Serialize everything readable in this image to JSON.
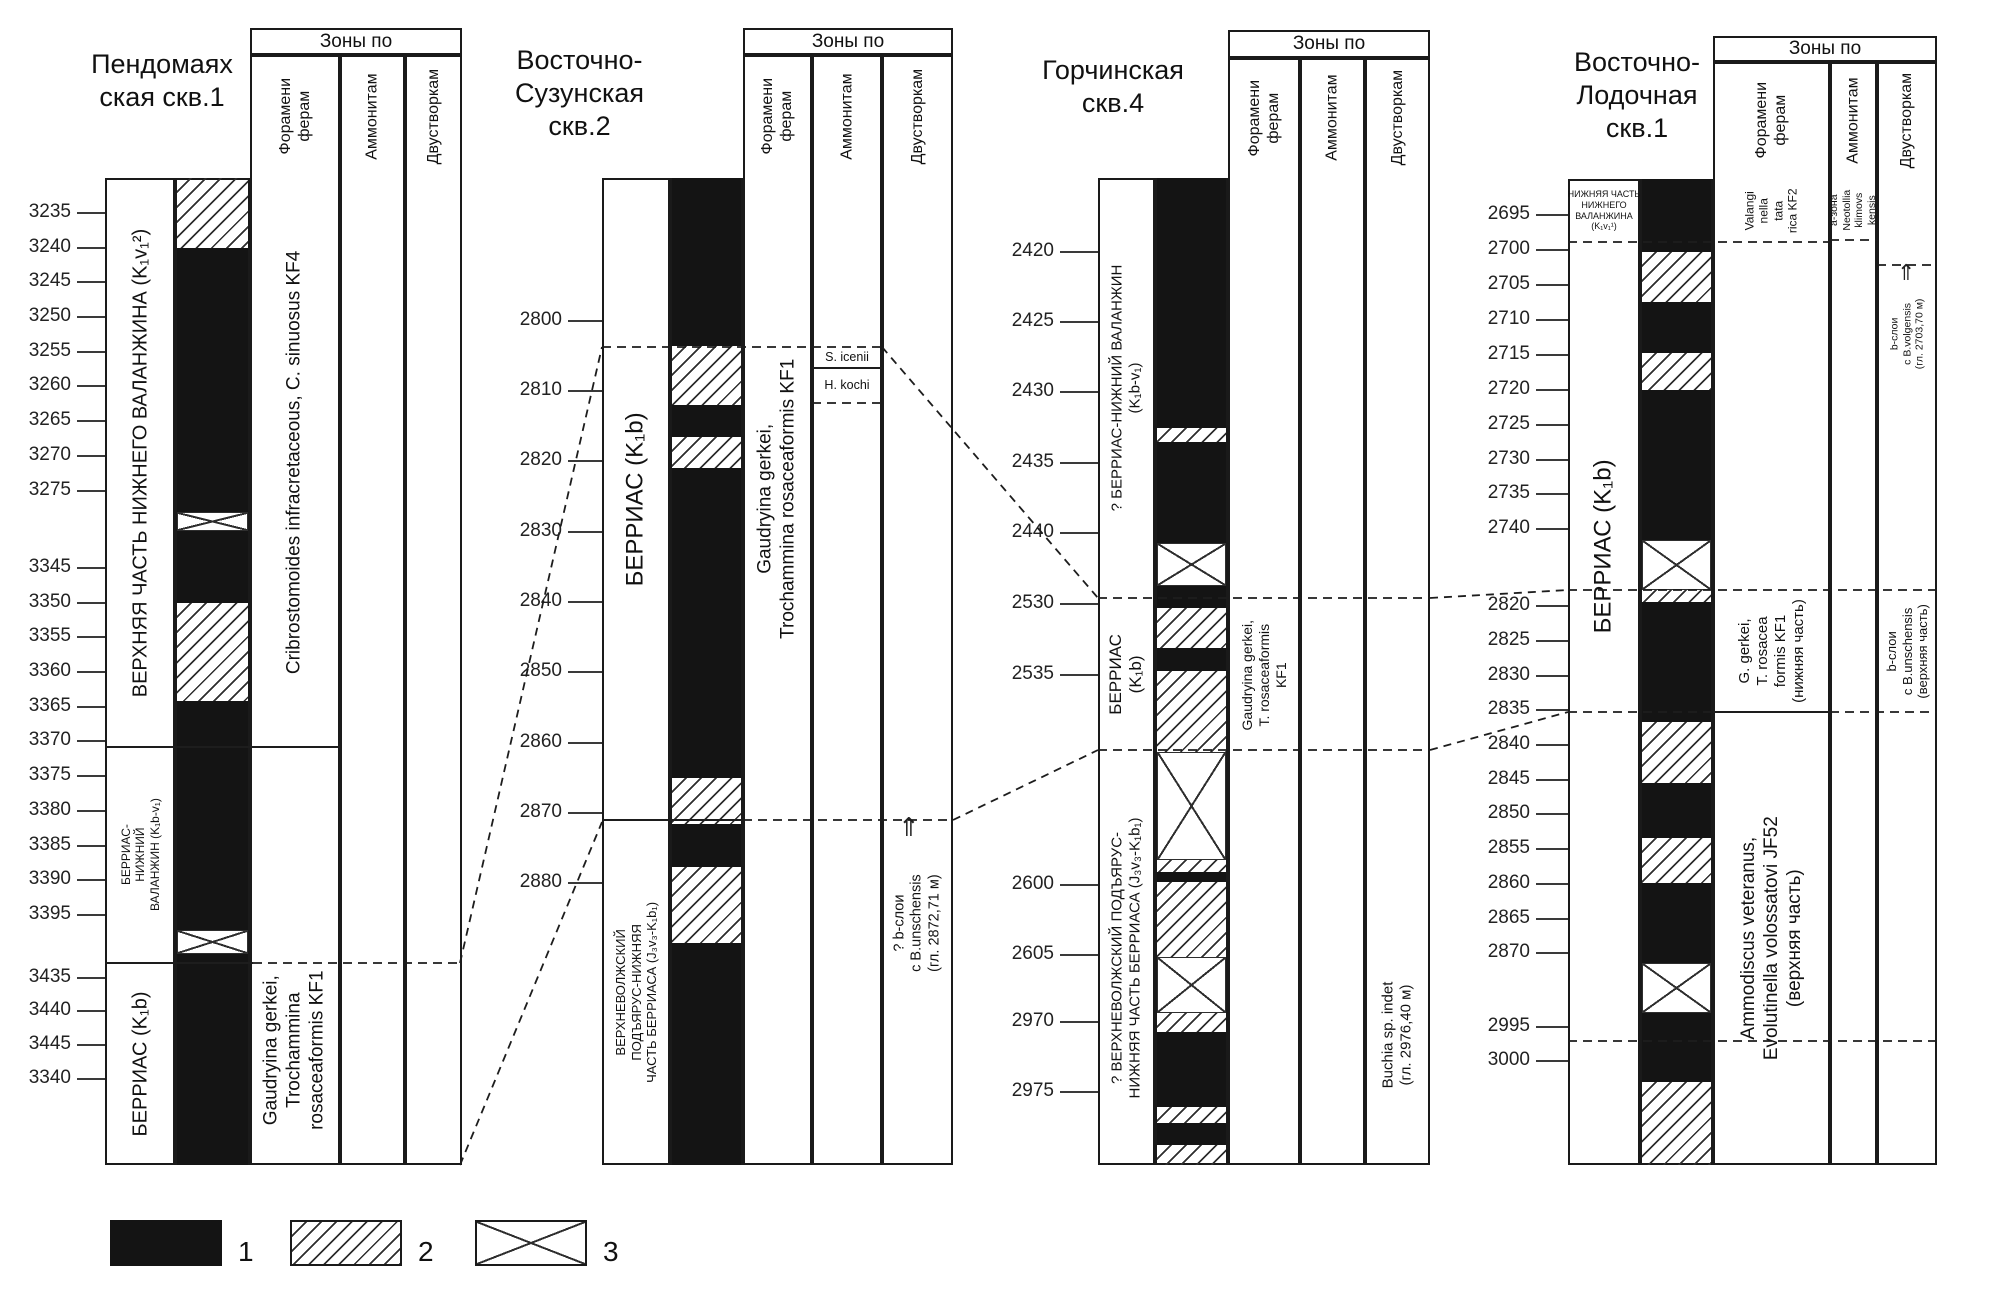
{
  "zones_header_label": "Зоны по",
  "legend": {
    "items": [
      {
        "label": "1",
        "pattern": "black"
      },
      {
        "label": "2",
        "pattern": "hatch"
      },
      {
        "label": "3",
        "pattern": "cross"
      }
    ]
  },
  "wells": [
    {
      "name": "Пендомаяхская скв.1",
      "title_lines": [
        "Пендомаях",
        "ская скв.1"
      ],
      "zones_header": "Зоны по",
      "zone_columns": [
        {
          "lines": [
            "Форамени",
            "ферам"
          ]
        },
        {
          "lines": [
            "Аммонитам"
          ]
        },
        {
          "lines": [
            "Двустворкам"
          ]
        }
      ],
      "depth_ticks": [
        {
          "label": "3235",
          "y": 213
        },
        {
          "label": "3240",
          "y": 248
        },
        {
          "label": "3245",
          "y": 282
        },
        {
          "label": "3250",
          "y": 317
        },
        {
          "label": "3255",
          "y": 352
        },
        {
          "label": "3260",
          "y": 386
        },
        {
          "label": "3265",
          "y": 421
        },
        {
          "label": "3270",
          "y": 456
        },
        {
          "label": "3275",
          "y": 491
        },
        {
          "label": "3345",
          "y": 568
        },
        {
          "label": "3350",
          "y": 603
        },
        {
          "label": "3355",
          "y": 637
        },
        {
          "label": "3360",
          "y": 672
        },
        {
          "label": "3365",
          "y": 707
        },
        {
          "label": "3370",
          "y": 741
        },
        {
          "label": "3375",
          "y": 776
        },
        {
          "label": "3380",
          "y": 811
        },
        {
          "label": "3385",
          "y": 846
        },
        {
          "label": "3390",
          "y": 880
        },
        {
          "label": "3395",
          "y": 915
        },
        {
          "label": "3435",
          "y": 978
        },
        {
          "label": "3440",
          "y": 1011
        },
        {
          "label": "3445",
          "y": 1045
        },
        {
          "label": "3340",
          "y": 1079
        }
      ],
      "strat_units": [
        {
          "lines": [
            "ВЕРХНЯЯ ЧАСТЬ НИЖНЕГО ВАЛАНЖИНА (K₁v₁²)"
          ],
          "y0": 178,
          "y1": 747,
          "font": 20,
          "rot": true
        },
        {
          "lines": [
            "БЕРРИАС-",
            "НИЖНИЙ",
            "ВАЛАНЖИН (K₁b-v₁)"
          ],
          "y0": 747,
          "y1": 963,
          "font": 12,
          "rot": true
        },
        {
          "lines": [
            "БЕРРИАС (K₁b)"
          ],
          "y0": 963,
          "y1": 1165,
          "font": 20,
          "rot": true
        }
      ],
      "litho": [
        [
          "hatch",
          178,
          248
        ],
        [
          "black",
          248,
          512
        ],
        [
          "cross",
          512,
          531
        ],
        [
          "black",
          531,
          603
        ],
        [
          "hatch",
          603,
          701
        ],
        [
          "black",
          701,
          930
        ],
        [
          "cross",
          930,
          954
        ],
        [
          "black",
          954,
          1165
        ]
      ],
      "zone_texts": [
        {
          "col": 0,
          "lines": [
            "Cribrostomoides infracretaceous, C. sinuosus KF4"
          ],
          "y0": 178,
          "y1": 747,
          "font": 19,
          "rot": true
        },
        {
          "col": 0,
          "lines": [
            "Gaudryina gerkei,",
            "Trochammina",
            "rosaceaformis KF1"
          ],
          "y0": 935,
          "y1": 1165,
          "font": 19,
          "rot": true
        }
      ],
      "arrows": []
    },
    {
      "name": "Восточно-Сузунская скв.2",
      "title_lines": [
        "Восточно-",
        "Сузунская",
        "скв.2"
      ],
      "zones_header": "Зоны по",
      "zone_columns": [
        {
          "lines": [
            "Форамени",
            "ферам"
          ]
        },
        {
          "lines": [
            "Аммонитам"
          ]
        },
        {
          "lines": [
            "Двустворкам"
          ]
        }
      ],
      "depth_ticks": [
        {
          "label": "2800",
          "y": 321
        },
        {
          "label": "2810",
          "y": 391
        },
        {
          "label": "2820",
          "y": 461
        },
        {
          "label": "2830",
          "y": 532
        },
        {
          "label": "2840",
          "y": 602
        },
        {
          "label": "2850",
          "y": 672
        },
        {
          "label": "2860",
          "y": 743
        },
        {
          "label": "2870",
          "y": 813
        },
        {
          "label": "2880",
          "y": 883
        }
      ],
      "strat_units": [
        {
          "lines": [
            "БЕРРИАС (K₁b)"
          ],
          "y0": 178,
          "y1": 820,
          "font": 24,
          "rot": true
        },
        {
          "lines": [
            "ВЕРХНЕВОЛЖСКИЙ",
            "ПОДЪЯРУС-НИЖНЯЯ",
            "ЧАСТЬ БЕРРИАСА (J₃v₃-K₁b₁)"
          ],
          "y0": 820,
          "y1": 1165,
          "font": 13,
          "rot": true
        }
      ],
      "litho": [
        [
          "black",
          178,
          346
        ],
        [
          "hatch",
          346,
          405
        ],
        [
          "black",
          405,
          437
        ],
        [
          "hatch",
          437,
          468
        ],
        [
          "black",
          468,
          778
        ],
        [
          "hatch",
          778,
          824
        ],
        [
          "black",
          824,
          867
        ],
        [
          "hatch",
          867,
          943
        ],
        [
          "black",
          943,
          1165
        ]
      ],
      "zone_texts": [
        {
          "col": 0,
          "lines": [
            "Gaudryina gerkei,",
            "Trochammina rosaceaformis KF1"
          ],
          "y0": 178,
          "y1": 820,
          "font": 19,
          "rot": true
        },
        {
          "col": 1,
          "lines": [
            "S. icenii"
          ],
          "y0": 347,
          "y1": 368,
          "font": 12.5,
          "rot": false
        },
        {
          "col": 1,
          "lines": [
            "H. kochi"
          ],
          "y0": 368,
          "y1": 403,
          "font": 12.5,
          "rot": false
        },
        {
          "col": 2,
          "lines": [
            "? b-слои",
            "с B.unschensis",
            "(гл. 2872,71 м)"
          ],
          "y0": 826,
          "y1": 1020,
          "font": 14.5,
          "rot": true
        }
      ],
      "arrows": [
        {
          "x": 898,
          "y": 814,
          "size": 26
        }
      ]
    },
    {
      "name": "Горчинская скв.4",
      "title_lines": [
        "Горчинская",
        "скв.4"
      ],
      "zones_header": "Зоны по",
      "zone_columns": [
        {
          "lines": [
            "Форамени",
            "ферам"
          ]
        },
        {
          "lines": [
            "Аммонитам"
          ]
        },
        {
          "lines": [
            "Двустворкам"
          ]
        }
      ],
      "depth_ticks": [
        {
          "label": "2420",
          "y": 252
        },
        {
          "label": "2425",
          "y": 322
        },
        {
          "label": "2430",
          "y": 392
        },
        {
          "label": "2435",
          "y": 463
        },
        {
          "label": "2440",
          "y": 533
        },
        {
          "label": "2530",
          "y": 604
        },
        {
          "label": "2535",
          "y": 675
        },
        {
          "label": "2600",
          "y": 885
        },
        {
          "label": "2605",
          "y": 955
        },
        {
          "label": "2970",
          "y": 1022
        },
        {
          "label": "2975",
          "y": 1092
        }
      ],
      "strat_units": [
        {
          "lines": [
            "? БЕРРИАС-НИЖНИЙ ВАЛАНЖИН",
            "(K₁b-v₁)"
          ],
          "y0": 178,
          "y1": 598,
          "font": 15,
          "rot": true
        },
        {
          "lines": [
            "БЕРРИАС",
            "(K₁b)"
          ],
          "y0": 598,
          "y1": 750,
          "font": 17,
          "rot": true
        },
        {
          "lines": [
            "? ВЕРХНЕВОЛЖСКИЙ ПОДЪЯРУС-",
            "НИЖНЯЯ ЧАСТЬ БЕРРИАСА (J₃v₃-K₁b₁)"
          ],
          "y0": 750,
          "y1": 1165,
          "font": 15,
          "rot": true
        }
      ],
      "litho": [
        [
          "black",
          178,
          428
        ],
        [
          "hatch",
          428,
          442
        ],
        [
          "black",
          442,
          543
        ],
        [
          "cross",
          543,
          586
        ],
        [
          "black",
          586,
          608
        ],
        [
          "hatch",
          608,
          648
        ],
        [
          "black",
          648,
          671
        ],
        [
          "hatch",
          671,
          752
        ],
        [
          "cross",
          752,
          860
        ],
        [
          "hatch",
          860,
          872
        ],
        [
          "black",
          872,
          882
        ],
        [
          "hatch",
          882,
          957
        ],
        [
          "cross",
          957,
          1013
        ],
        [
          "hatch",
          1013,
          1032
        ],
        [
          "black",
          1032,
          1107
        ],
        [
          "hatch",
          1107,
          1123
        ],
        [
          "black",
          1123,
          1145
        ],
        [
          "hatch",
          1145,
          1165
        ]
      ],
      "zone_texts": [
        {
          "col": 0,
          "lines": [
            "Gaudryina gerkei,",
            "T. rosaceaformis",
            "KF1"
          ],
          "y0": 555,
          "y1": 795,
          "font": 14,
          "rot": true
        },
        {
          "col": 2,
          "lines": [
            "Buchia sp. indet",
            "(гл. 2976,40 м)"
          ],
          "y0": 925,
          "y1": 1145,
          "font": 15,
          "rot": true
        }
      ],
      "arrows": []
    },
    {
      "name": "Восточно-Лодочная скв.1",
      "title_lines": [
        "Восточно-",
        "Лодочная",
        "скв.1"
      ],
      "zones_header": "Зоны по",
      "zone_columns": [
        {
          "lines": [
            "Форамени",
            "ферам"
          ]
        },
        {
          "lines": [
            "Аммонитам"
          ]
        },
        {
          "lines": [
            "Двустворкам"
          ]
        }
      ],
      "depth_ticks": [
        {
          "label": "2695",
          "y": 215
        },
        {
          "label": "2700",
          "y": 250
        },
        {
          "label": "2705",
          "y": 285
        },
        {
          "label": "2710",
          "y": 320
        },
        {
          "label": "2715",
          "y": 355
        },
        {
          "label": "2720",
          "y": 390
        },
        {
          "label": "2725",
          "y": 425
        },
        {
          "label": "2730",
          "y": 460
        },
        {
          "label": "2735",
          "y": 494
        },
        {
          "label": "2740",
          "y": 529
        },
        {
          "label": "2820",
          "y": 606
        },
        {
          "label": "2825",
          "y": 641
        },
        {
          "label": "2830",
          "y": 676
        },
        {
          "label": "2835",
          "y": 710
        },
        {
          "label": "2840",
          "y": 745
        },
        {
          "label": "2845",
          "y": 780
        },
        {
          "label": "2850",
          "y": 814
        },
        {
          "label": "2855",
          "y": 849
        },
        {
          "label": "2860",
          "y": 884
        },
        {
          "label": "2865",
          "y": 919
        },
        {
          "label": "2870",
          "y": 953
        },
        {
          "label": "2995",
          "y": 1027
        },
        {
          "label": "3000",
          "y": 1061
        }
      ],
      "strat_units": [
        {
          "lines": [
            "НИЖНЯЯ ЧАСТЬ",
            "НИЖНЕГО",
            "ВАЛАНЖИНА",
            "(K₁v₁¹)"
          ],
          "y0": 179,
          "y1": 242,
          "font": 9,
          "rot": false
        },
        {
          "lines": [
            "БЕРРИАС (K₁b)"
          ],
          "y0": 242,
          "y1": 850,
          "font": 24,
          "rot": true
        }
      ],
      "litho": [
        [
          "black",
          179,
          252
        ],
        [
          "hatch",
          252,
          302
        ],
        [
          "black",
          302,
          353
        ],
        [
          "hatch",
          353,
          390
        ],
        [
          "black",
          390,
          540
        ],
        [
          "cross",
          540,
          590
        ],
        [
          "hatch",
          590,
          602
        ],
        [
          "black",
          602,
          722
        ],
        [
          "hatch",
          722,
          783
        ],
        [
          "black",
          783,
          838
        ],
        [
          "hatch",
          838,
          883
        ],
        [
          "black",
          883,
          963
        ],
        [
          "cross",
          963,
          1013
        ],
        [
          "black",
          1013,
          1082
        ],
        [
          "hatch",
          1082,
          1165
        ]
      ],
      "zone_texts": [
        {
          "col": 0,
          "lines": [
            "Valangi",
            "nella",
            "tata",
            "rica KF2"
          ],
          "y0": 179,
          "y1": 242,
          "font": 12,
          "rot": true
        },
        {
          "col": 1,
          "lines": [
            "a-зона",
            "Neotollia",
            "klimovs",
            "kensis"
          ],
          "y0": 179,
          "y1": 242,
          "font": 10.5,
          "rot": true
        },
        {
          "col": 2,
          "lines": [
            "b-слои",
            "с B.volgensis",
            "(гл. 2703,70 м)"
          ],
          "y0": 268,
          "y1": 400,
          "font": 10.5,
          "rot": true
        },
        {
          "col": 0,
          "lines": [
            "G. gerkei,",
            "T. rosacea",
            "formis KF1",
            "(нижняя часть)"
          ],
          "y0": 590,
          "y1": 712,
          "font": 15,
          "rot": true
        },
        {
          "col": 0,
          "lines": [
            "Ammodiscus veteranus,",
            "Evolutinella volossatovi JF52",
            "(верхняя часть)"
          ],
          "y0": 712,
          "y1": 1165,
          "font": 19,
          "rot": true
        },
        {
          "col": 2,
          "lines": [
            "b-слои",
            "с B.unschensis",
            "(верхняя часть)"
          ],
          "y0": 588,
          "y1": 714,
          "font": 13,
          "rot": true
        }
      ],
      "arrows": [
        {
          "x": 1897,
          "y": 262,
          "size": 22
        }
      ]
    }
  ],
  "boundaries": {
    "solid": [
      [
        105,
        340,
        747
      ],
      [
        105,
        253,
        963
      ],
      [
        602,
        743,
        820
      ],
      [
        812,
        882,
        368
      ],
      [
        1713,
        1830,
        712
      ]
    ],
    "dashed": [
      [
        253,
        462,
        963
      ],
      [
        602,
        882,
        347
      ],
      [
        812,
        882,
        403
      ],
      [
        743,
        953,
        820
      ],
      [
        1098,
        1430,
        598
      ],
      [
        1098,
        1430,
        750
      ],
      [
        1568,
        1830,
        242
      ],
      [
        1830,
        1877,
        240
      ],
      [
        1877,
        1937,
        265
      ],
      [
        1568,
        1937,
        590
      ],
      [
        1568,
        1713,
        712
      ],
      [
        1830,
        1937,
        712
      ],
      [
        1568,
        1937,
        1041
      ]
    ],
    "diagonal": [
      [
        460,
        963,
        602,
        347
      ],
      [
        460,
        1165,
        602,
        822
      ],
      [
        882,
        347,
        1098,
        598
      ],
      [
        953,
        820,
        1098,
        750
      ],
      [
        1430,
        598,
        1568,
        590
      ],
      [
        1430,
        750,
        1568,
        712
      ]
    ]
  }
}
